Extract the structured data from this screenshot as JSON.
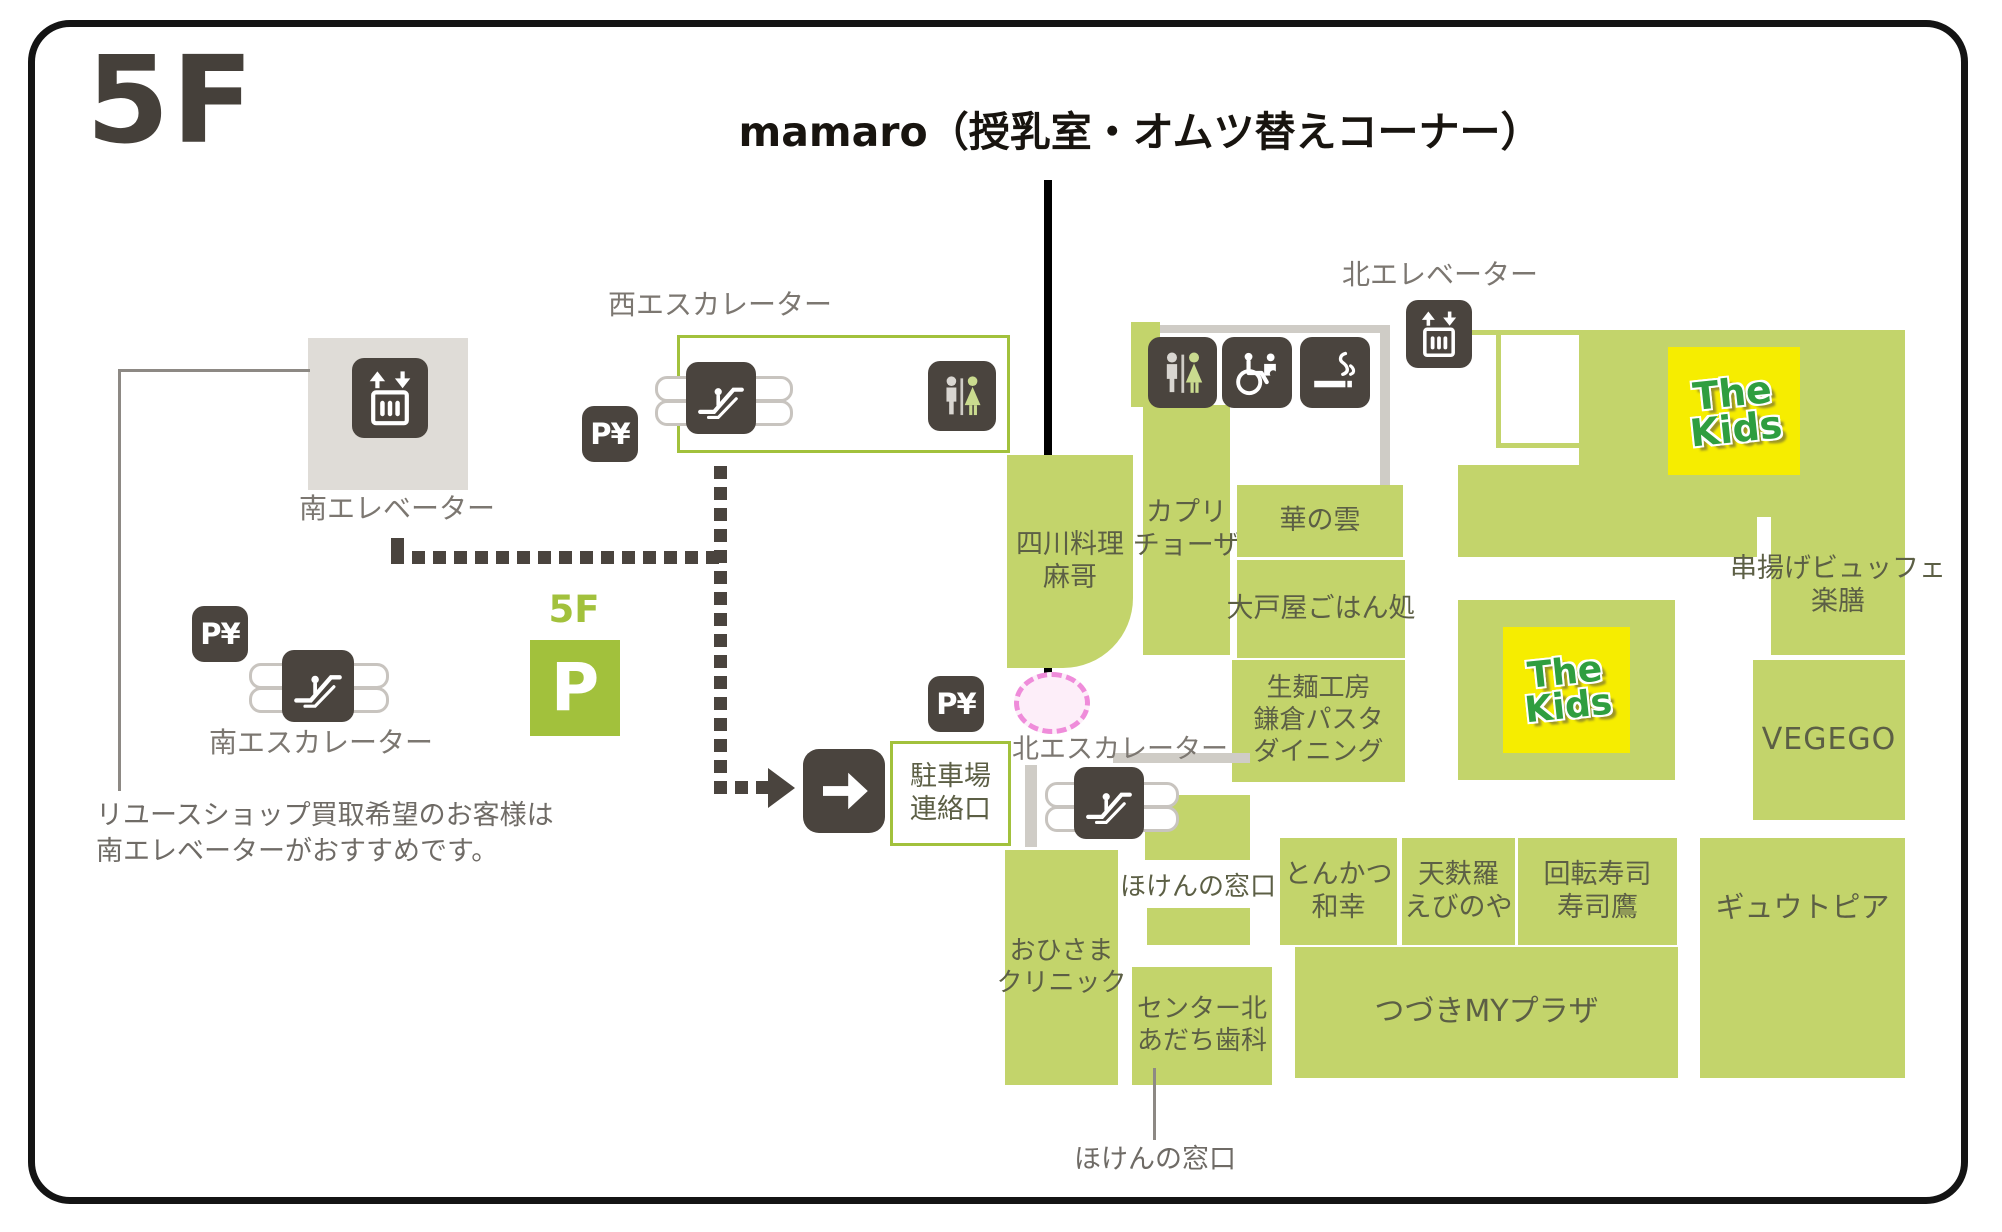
{
  "title": "5F",
  "annotation": {
    "label": "mamaro（授乳室・オムツ替えコーナー）"
  },
  "facilities": {
    "north_elevator_label": "北エレベーター",
    "south_elevator_label": "南エレベーター",
    "west_escalator_label": "西エスカレーター",
    "south_escalator_label": "南エスカレーター",
    "north_escalator_label": "北エスカレーター",
    "parking_floor": "5F",
    "parking_letter": "P",
    "pay_parking": "P¥",
    "parking_gate": "駐車場\n連絡口"
  },
  "note": "リユースショップ買取希望のお客様は\n南エレベーターがおすすめです。",
  "stores": {
    "shisen_ryori_mako": "四川料理\n麻哥",
    "capricciosa": "カプリ\nチョーザ",
    "hana_no_kumo": "華の雲",
    "ootoya_gohandokoro": "大戸屋ごはん処",
    "kamakura_pasta": "生麺工房\n鎌倉パスタ\nダイニング",
    "kushiage_buffet_rakuzen": "串揚げビュッフェ\n楽膳",
    "the_kids_logo": "The\nKids",
    "vegego": "VEGEGO",
    "hoken_no_madoguchi": "ほけんの窓口",
    "tonkatsu_wako": "とんかつ\n和幸",
    "tempura_ebinoya": "天麩羅\nえびのや",
    "kaiten_sushi_sushitaka": "回転寿司\n寿司鷹",
    "gyutopia": "ギュウトピア",
    "ohisama_clinic": "おひさま\nクリニック",
    "center_kita_adachi_dental": "センター北\nあだち歯科",
    "tsuzuki_my_plaza": "つづきMYプラザ",
    "hoken_no_madoguchi_pointer": "ほけんの窓口"
  },
  "colors": {
    "store_green": "#c3d46b",
    "accent_green": "#a2c13c",
    "icon_dark": "#4a443e",
    "kids_yellow": "#f6ed00",
    "kids_green": "#2f9e3f",
    "mamaro_pink": "#ef8cda",
    "elevator_area_gray": "#dfdcd7"
  }
}
